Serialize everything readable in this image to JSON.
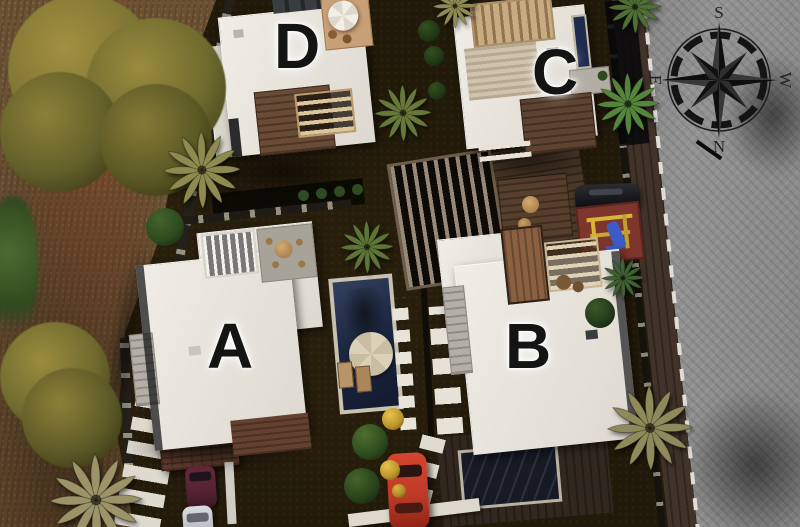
{
  "scene": {
    "description": "Aerial 3D site plan of a gated complex with four labeled villas, gardens, pools, palm trees and a paved street with a compass rose",
    "villas": [
      {
        "id": "villa-a",
        "label": "A"
      },
      {
        "id": "villa-b",
        "label": "B"
      },
      {
        "id": "villa-c",
        "label": "C"
      },
      {
        "id": "villa-d",
        "label": "D"
      }
    ],
    "compass": {
      "south": "S",
      "north": "N",
      "east": "E",
      "west": "W"
    },
    "palette": {
      "soil": "#211909",
      "dirt": "#6b5133",
      "road": "#8a8a8a",
      "villa_roof": "#e8e5de",
      "pool_deep_blue": "#222f4e",
      "pool_dark": "#181c26",
      "wood_deck": "#6a4b36",
      "letter": "#141414",
      "car_red": "#bf3a28",
      "car_black": "#17171c",
      "car_silver": "#c6c8cc",
      "car_maroon": "#552133",
      "playground_ground": "#7e352c"
    }
  }
}
